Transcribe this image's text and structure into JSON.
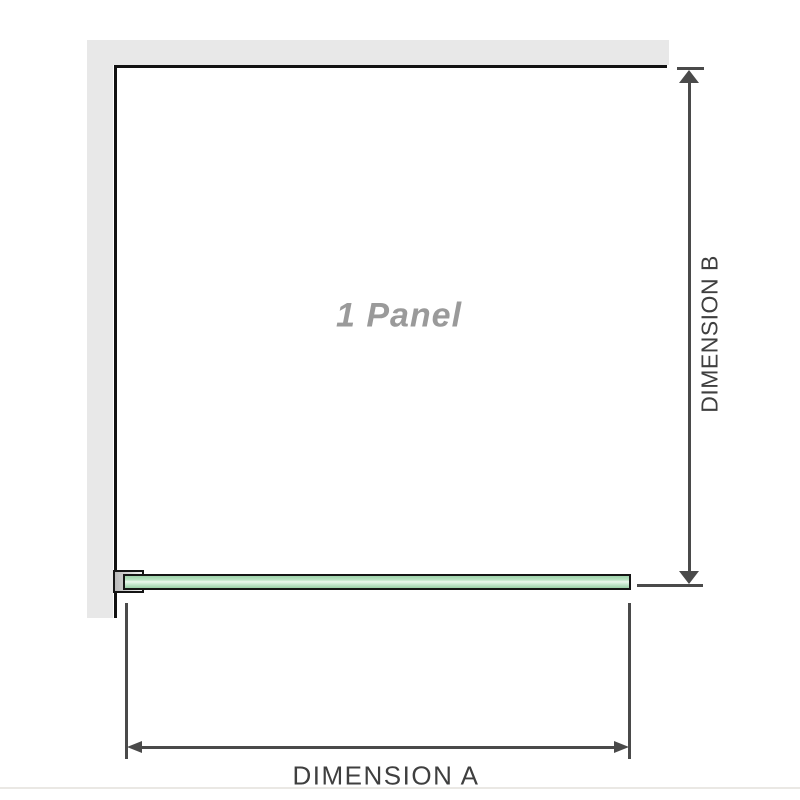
{
  "diagram": {
    "panel_label": "1 Panel",
    "dimension_a_label": "DIMENSION A",
    "dimension_b_label": "DIMENSION B",
    "colors": {
      "wall_fill": "#e8e8e8",
      "panel_border": "#121212",
      "glass_fill_green": "#9fd3ab",
      "glass_highlight": "#ecf8ee",
      "glass_border": "#161616",
      "bracket_fill_start": "#b9b9b9",
      "bracket_fill_end": "#f3f3f3",
      "dimension_line": "#4a4a4a",
      "dimension_label_text": "#3f3f3f",
      "panel_label_text": "#9a9a9a",
      "bottom_divider": "#eae8e4"
    }
  }
}
